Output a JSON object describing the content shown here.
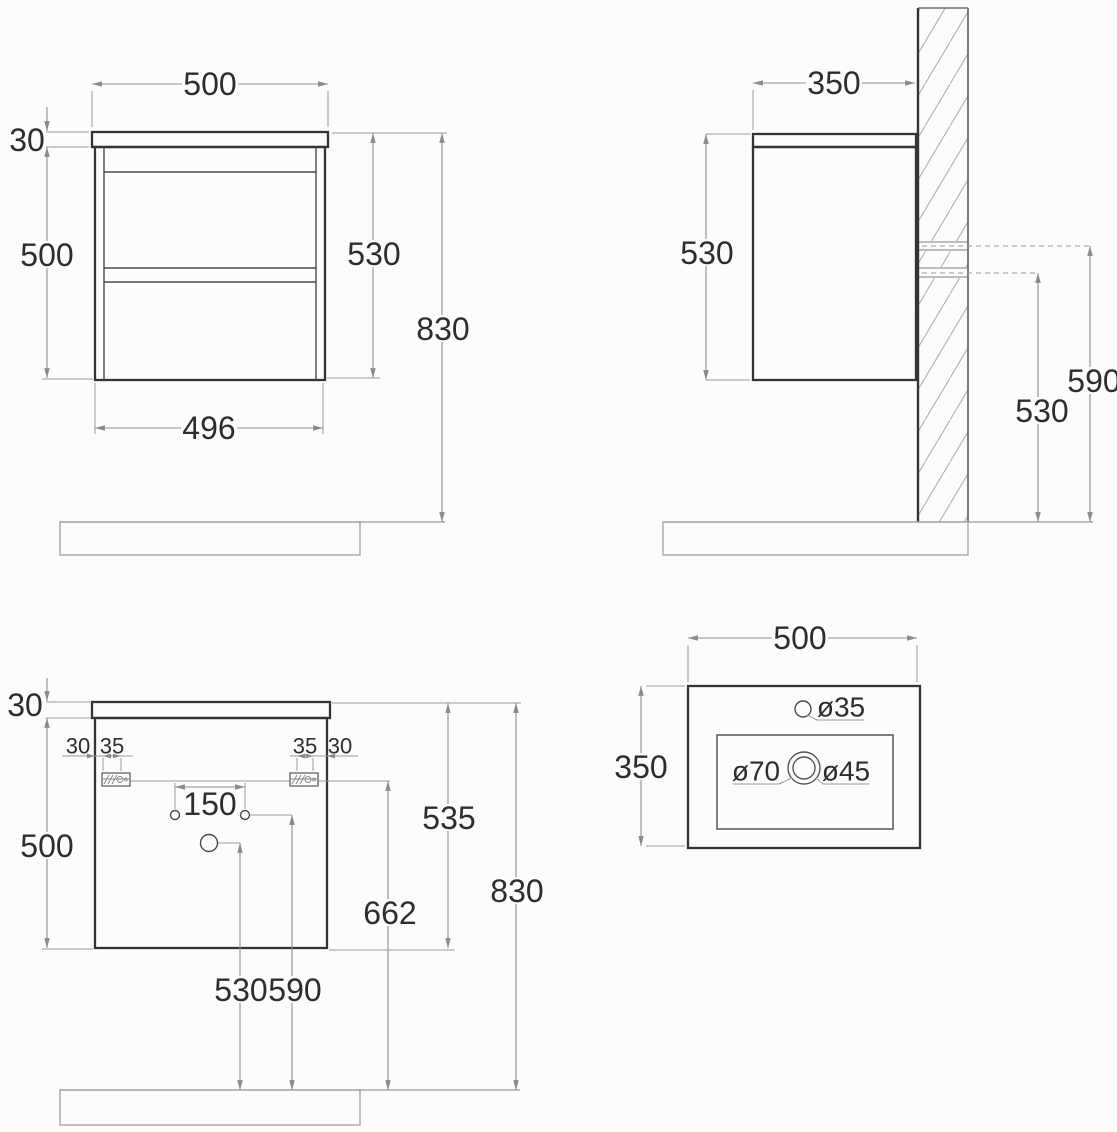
{
  "views": {
    "front": {
      "top_width": "500",
      "top_thickness": "30",
      "body_height": "500",
      "height": "530",
      "total_height": "830",
      "bottom_width": "496"
    },
    "side": {
      "depth": "350",
      "height": "530",
      "upper_mount_height": "590",
      "lower_mount_height": "530"
    },
    "back": {
      "top_thickness": "30",
      "body_height": "500",
      "left_offset": "30",
      "left_bracket_width": "35",
      "right_bracket_width": "35",
      "right_offset": "30",
      "hole_spacing": "150",
      "inner_height": "535",
      "rail_height": "662",
      "total_height": "830",
      "drain_height": "530",
      "supply_height": "590"
    },
    "basin": {
      "width": "500",
      "depth": "350",
      "faucet_hole": "ø35",
      "overflow": "ø70",
      "drain": "ø45"
    }
  }
}
